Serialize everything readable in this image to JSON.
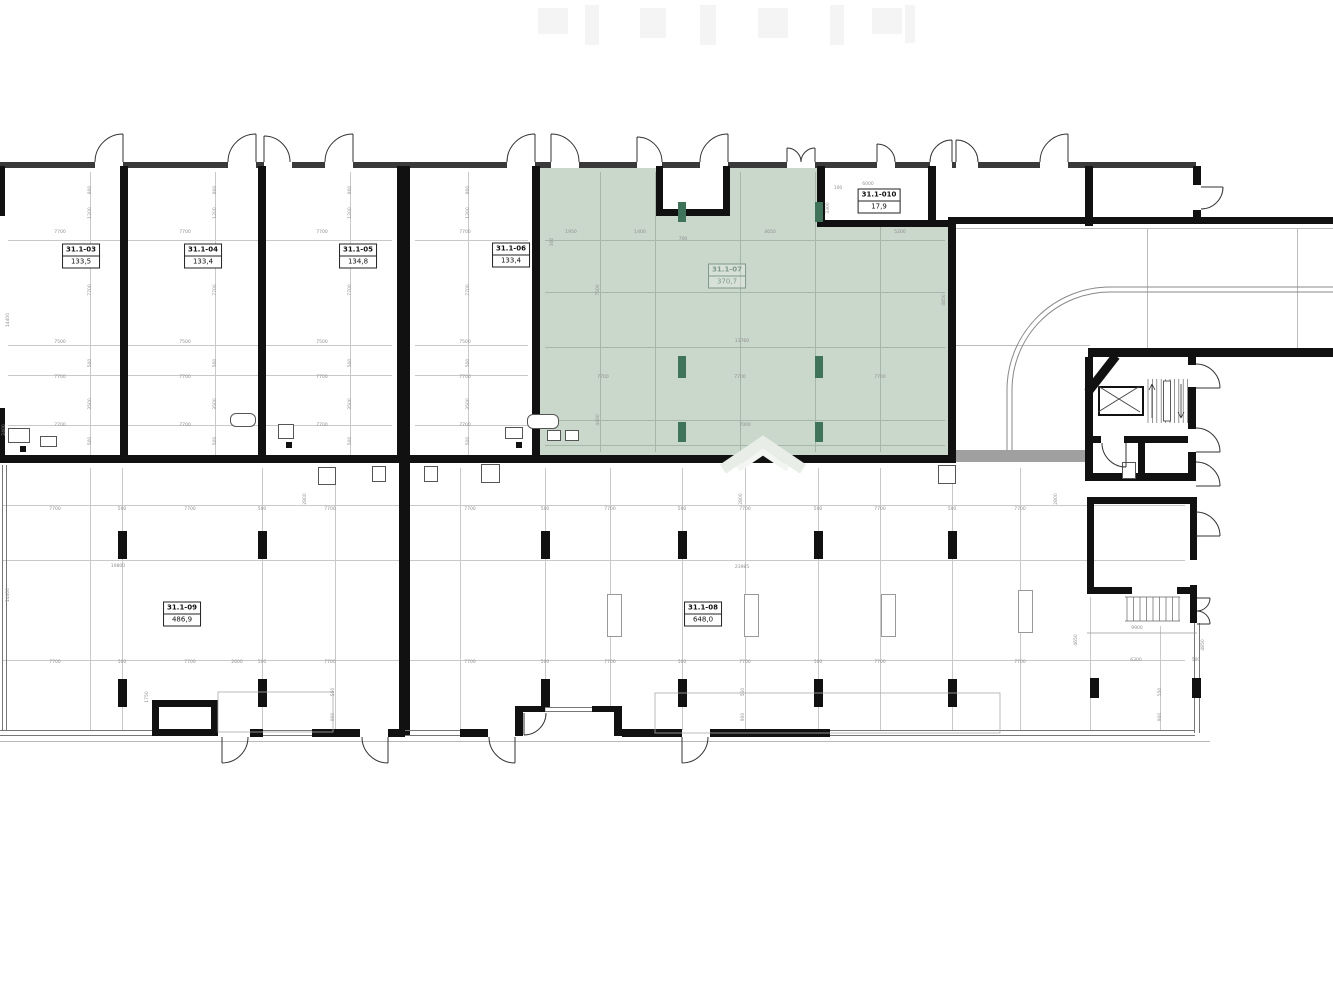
{
  "drawing": {
    "kind": "architectural floor plan",
    "highlighted_room": "31.1-07",
    "colors": {
      "highlight_fill": "#cad7cb",
      "column_accent": "#40745a",
      "wall": "#111111",
      "grid": "#c9c9c9"
    }
  },
  "rooms": [
    {
      "id": "31.1-03",
      "area": "133,5",
      "cx": 81,
      "cy": 256,
      "highlight": false
    },
    {
      "id": "31.1-04",
      "area": "133,4",
      "cx": 203,
      "cy": 256,
      "highlight": false
    },
    {
      "id": "31.1-05",
      "area": "134,8",
      "cx": 358,
      "cy": 256,
      "highlight": false
    },
    {
      "id": "31.1-06",
      "area": "133,4",
      "cx": 511,
      "cy": 255,
      "highlight": false
    },
    {
      "id": "31.1-07",
      "area": "370,7",
      "cx": 727,
      "cy": 276,
      "highlight": true
    },
    {
      "id": "31.1-010",
      "area": "17,9",
      "cx": 879,
      "cy": 201,
      "highlight": false
    },
    {
      "id": "31.1-09",
      "area": "486,9",
      "cx": 182,
      "cy": 614,
      "highlight": false
    },
    {
      "id": "31.1-08",
      "area": "648,0",
      "cx": 703,
      "cy": 614,
      "highlight": false
    }
  ],
  "dims": [
    {
      "x": 90,
      "y": 190,
      "t": "900",
      "r": 1
    },
    {
      "x": 90,
      "y": 213,
      "t": "1200",
      "r": 1
    },
    {
      "x": 90,
      "y": 290,
      "t": "7700",
      "r": 1
    },
    {
      "x": 90,
      "y": 363,
      "t": "500",
      "r": 1
    },
    {
      "x": 90,
      "y": 404,
      "t": "3500",
      "r": 1
    },
    {
      "x": 90,
      "y": 441,
      "t": "500",
      "r": 1
    },
    {
      "x": 215,
      "y": 190,
      "t": "900",
      "r": 1
    },
    {
      "x": 215,
      "y": 213,
      "t": "1200",
      "r": 1
    },
    {
      "x": 215,
      "y": 290,
      "t": "7700",
      "r": 1
    },
    {
      "x": 215,
      "y": 363,
      "t": "500",
      "r": 1
    },
    {
      "x": 215,
      "y": 404,
      "t": "3500",
      "r": 1
    },
    {
      "x": 215,
      "y": 441,
      "t": "500",
      "r": 1
    },
    {
      "x": 350,
      "y": 190,
      "t": "900",
      "r": 1
    },
    {
      "x": 350,
      "y": 213,
      "t": "1200",
      "r": 1
    },
    {
      "x": 350,
      "y": 290,
      "t": "7700",
      "r": 1
    },
    {
      "x": 350,
      "y": 363,
      "t": "500",
      "r": 1
    },
    {
      "x": 350,
      "y": 404,
      "t": "3500",
      "r": 1
    },
    {
      "x": 350,
      "y": 441,
      "t": "500",
      "r": 1
    },
    {
      "x": 468,
      "y": 190,
      "t": "900",
      "r": 1
    },
    {
      "x": 468,
      "y": 213,
      "t": "1200",
      "r": 1
    },
    {
      "x": 468,
      "y": 290,
      "t": "7700",
      "r": 1
    },
    {
      "x": 468,
      "y": 363,
      "t": "500",
      "r": 1
    },
    {
      "x": 468,
      "y": 404,
      "t": "3500",
      "r": 1
    },
    {
      "x": 468,
      "y": 441,
      "t": "500",
      "r": 1
    },
    {
      "x": 60,
      "y": 232,
      "t": "7700"
    },
    {
      "x": 60,
      "y": 342,
      "t": "7500"
    },
    {
      "x": 60,
      "y": 377,
      "t": "7700"
    },
    {
      "x": 60,
      "y": 425,
      "t": "7700"
    },
    {
      "x": 185,
      "y": 232,
      "t": "7700"
    },
    {
      "x": 185,
      "y": 342,
      "t": "7500"
    },
    {
      "x": 185,
      "y": 377,
      "t": "7700"
    },
    {
      "x": 185,
      "y": 425,
      "t": "7700"
    },
    {
      "x": 322,
      "y": 232,
      "t": "7700"
    },
    {
      "x": 322,
      "y": 342,
      "t": "7500"
    },
    {
      "x": 322,
      "y": 377,
      "t": "7700"
    },
    {
      "x": 322,
      "y": 425,
      "t": "7700"
    },
    {
      "x": 465,
      "y": 232,
      "t": "7700"
    },
    {
      "x": 465,
      "y": 342,
      "t": "7500"
    },
    {
      "x": 465,
      "y": 377,
      "t": "7700"
    },
    {
      "x": 465,
      "y": 425,
      "t": "7700"
    },
    {
      "x": 8,
      "y": 320,
      "t": "14400",
      "r": 1
    },
    {
      "x": 8,
      "y": 595,
      "t": "14400",
      "r": 1
    },
    {
      "x": 4,
      "y": 430,
      "t": "2400",
      "r": 1
    },
    {
      "x": 571,
      "y": 232,
      "t": "1950"
    },
    {
      "x": 640,
      "y": 232,
      "t": "1400"
    },
    {
      "x": 683,
      "y": 239,
      "t": "700"
    },
    {
      "x": 770,
      "y": 232,
      "t": "4650"
    },
    {
      "x": 900,
      "y": 232,
      "t": "5200"
    },
    {
      "x": 598,
      "y": 290,
      "t": "7500",
      "r": 1
    },
    {
      "x": 598,
      "y": 420,
      "t": "4400",
      "r": 1
    },
    {
      "x": 742,
      "y": 341,
      "t": "13760"
    },
    {
      "x": 944,
      "y": 300,
      "t": "4850",
      "r": 1
    },
    {
      "x": 603,
      "y": 377,
      "t": "7700"
    },
    {
      "x": 740,
      "y": 377,
      "t": "7700"
    },
    {
      "x": 880,
      "y": 377,
      "t": "7700"
    },
    {
      "x": 745,
      "y": 425,
      "t": "7000"
    },
    {
      "x": 838,
      "y": 188,
      "t": "100"
    },
    {
      "x": 828,
      "y": 208,
      "t": "3300",
      "r": 1
    },
    {
      "x": 868,
      "y": 184,
      "t": "6000"
    },
    {
      "x": 552,
      "y": 242,
      "t": "300",
      "r": 1
    },
    {
      "x": 55,
      "y": 509,
      "t": "7700"
    },
    {
      "x": 190,
      "y": 509,
      "t": "7700"
    },
    {
      "x": 330,
      "y": 509,
      "t": "7700"
    },
    {
      "x": 470,
      "y": 509,
      "t": "7700"
    },
    {
      "x": 610,
      "y": 509,
      "t": "7700"
    },
    {
      "x": 745,
      "y": 509,
      "t": "7700"
    },
    {
      "x": 880,
      "y": 509,
      "t": "7700"
    },
    {
      "x": 1020,
      "y": 509,
      "t": "7700"
    },
    {
      "x": 122,
      "y": 509,
      "t": "500"
    },
    {
      "x": 262,
      "y": 509,
      "t": "500"
    },
    {
      "x": 545,
      "y": 509,
      "t": "500"
    },
    {
      "x": 682,
      "y": 509,
      "t": "500"
    },
    {
      "x": 818,
      "y": 509,
      "t": "500"
    },
    {
      "x": 952,
      "y": 509,
      "t": "500"
    },
    {
      "x": 305,
      "y": 499,
      "t": "2800",
      "r": 1
    },
    {
      "x": 741,
      "y": 499,
      "t": "2800",
      "r": 1
    },
    {
      "x": 1056,
      "y": 499,
      "t": "2800",
      "r": 1
    },
    {
      "x": 55,
      "y": 662,
      "t": "7700"
    },
    {
      "x": 190,
      "y": 662,
      "t": "7700"
    },
    {
      "x": 330,
      "y": 662,
      "t": "7700"
    },
    {
      "x": 470,
      "y": 662,
      "t": "7700"
    },
    {
      "x": 610,
      "y": 662,
      "t": "7700"
    },
    {
      "x": 745,
      "y": 662,
      "t": "7700"
    },
    {
      "x": 880,
      "y": 662,
      "t": "7700"
    },
    {
      "x": 1020,
      "y": 662,
      "t": "7700"
    },
    {
      "x": 122,
      "y": 662,
      "t": "500"
    },
    {
      "x": 262,
      "y": 662,
      "t": "500"
    },
    {
      "x": 545,
      "y": 662,
      "t": "500"
    },
    {
      "x": 682,
      "y": 662,
      "t": "500"
    },
    {
      "x": 818,
      "y": 662,
      "t": "500"
    },
    {
      "x": 237,
      "y": 662,
      "t": "2600"
    },
    {
      "x": 1136,
      "y": 660,
      "t": "6300"
    },
    {
      "x": 1196,
      "y": 660,
      "t": "500"
    },
    {
      "x": 118,
      "y": 566,
      "t": "19800"
    },
    {
      "x": 742,
      "y": 567,
      "t": "23985"
    },
    {
      "x": 333,
      "y": 692,
      "t": "550",
      "r": 1
    },
    {
      "x": 333,
      "y": 717,
      "t": "900",
      "r": 1
    },
    {
      "x": 743,
      "y": 692,
      "t": "550",
      "r": 1
    },
    {
      "x": 743,
      "y": 717,
      "t": "900",
      "r": 1
    },
    {
      "x": 1160,
      "y": 692,
      "t": "550",
      "r": 1
    },
    {
      "x": 1160,
      "y": 717,
      "t": "900",
      "r": 1
    },
    {
      "x": 1137,
      "y": 628,
      "t": "9900"
    },
    {
      "x": 1076,
      "y": 640,
      "t": "4650",
      "r": 1
    },
    {
      "x": 1203,
      "y": 645,
      "t": "4850",
      "r": 1
    },
    {
      "x": 147,
      "y": 697,
      "t": "1750",
      "r": 1
    }
  ]
}
